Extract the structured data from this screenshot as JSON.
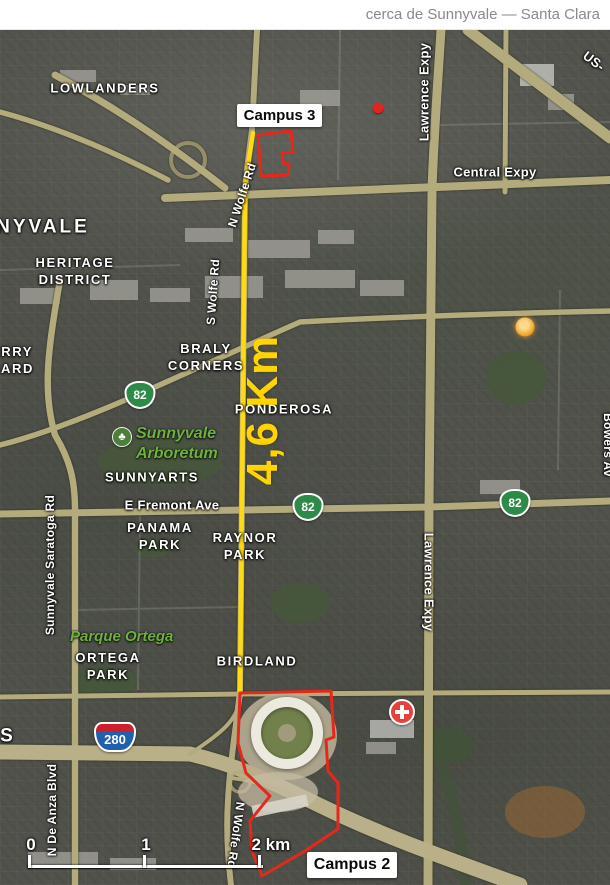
{
  "header": {
    "title": "cerca de Sunnyvale — Santa Clara"
  },
  "colors": {
    "route_yellow": "#FFD912",
    "outline_red": "#E5281C",
    "shield_green": "#2E8B47",
    "interstate_blue": "#2060AE",
    "interstate_red": "#CE2029",
    "park_label_green": "#6FB03F",
    "hospital_red": "#E8403A",
    "road_tan": "#B3AA7D"
  },
  "route": {
    "distance_label": "4,6 Km"
  },
  "annotations": {
    "campus3": "Campus 3",
    "campus2": "Campus 2"
  },
  "neighborhoods": {
    "lowlanders": "LOWLANDERS",
    "nyvale": "NYVALE",
    "heritage1": "HERITAGE",
    "heritage2": "DISTRICT",
    "cherry1": "ERRY",
    "cherry2": "HARD",
    "braly1": "BRALY",
    "braly2": "CORNERS",
    "ponderosa": "PONDEROSA",
    "sunnyarts": "SUNNYARTS",
    "panama1": "PANAMA",
    "panama2": "PARK",
    "raynor1": "RAYNOR",
    "raynor2": "PARK",
    "ortega1": "ORTEGA",
    "ortega2": "PARK",
    "birdland": "BIRDLAND",
    "s_partial": "S"
  },
  "parks": {
    "arboretum1": "Sunnyvale",
    "arboretum2": "Arboretum",
    "parque_ortega": "Parque Ortega",
    "tree_glyph": "♣"
  },
  "roads": {
    "central": "Central Expy",
    "lawrence_top": "Lawrence Expy",
    "lawrence_bottom": "Lawrence Expy",
    "us_partial": "US-",
    "fremont": "E Fremont Ave",
    "saratoga": "Sunnyvale Saratoga Rd",
    "deanza": "N De Anza Blvd",
    "wolfe_north": "N Wolfe Rd",
    "wolfe_south": "S Wolfe Rd",
    "wolfe_bottom": "N Wolfe Rd",
    "bowers_partial": "Bowers Av"
  },
  "shields": {
    "ca82": "82",
    "i280": "280"
  },
  "scale_bar": {
    "t0": "0",
    "t1": "1",
    "t2": "2 km"
  }
}
